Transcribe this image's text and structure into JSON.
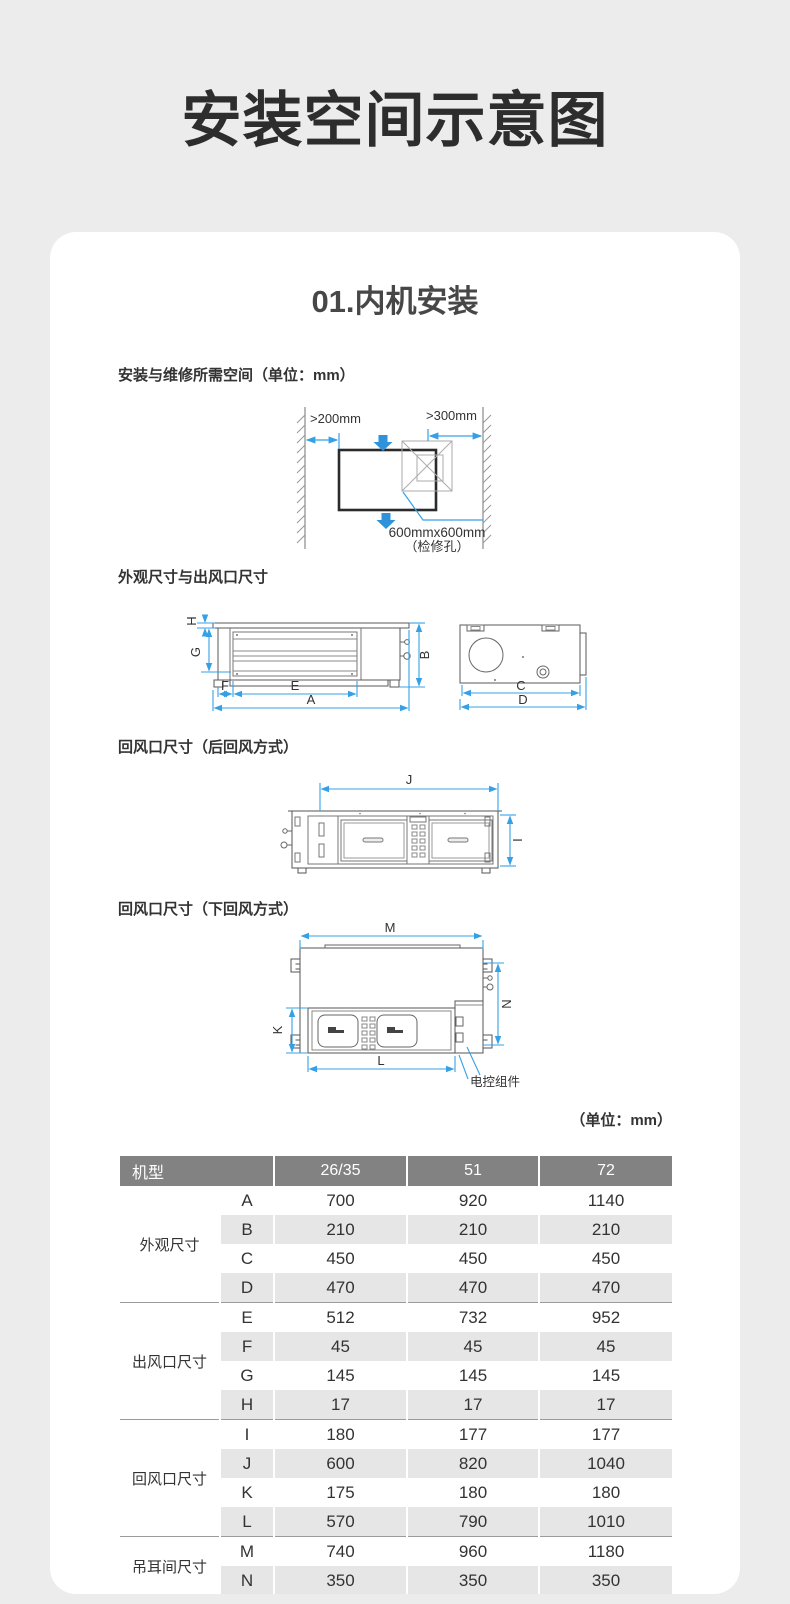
{
  "page": {
    "title": "安装空间示意图",
    "card_title": "01.内机安装",
    "unit_note": "（单位：mm）"
  },
  "colors": {
    "accent_blue": "#35A0E5",
    "arrow_blue": "#2E93DB",
    "table_header_bg": "#828282",
    "table_stripe": "#E6E6E6",
    "page_bg": "#ECECEC"
  },
  "sections": {
    "service_space": {
      "title": "安装与维修所需空间（单位：mm）",
      "left_clearance": ">200mm",
      "right_clearance": ">300mm",
      "hole_size": "600mmx600mm",
      "hole_name": "（检修孔）"
    },
    "outline": {
      "title": "外观尺寸与出风口尺寸",
      "dims": {
        "a": "A",
        "b": "B",
        "c": "C",
        "d": "D",
        "e": "E",
        "f": "F",
        "g": "G",
        "h": "H"
      }
    },
    "rear_return": {
      "title": "回风口尺寸（后回风方式）",
      "dims": {
        "i": "I",
        "j": "J"
      }
    },
    "bottom_return": {
      "title": "回风口尺寸（下回风方式）",
      "dims": {
        "k": "K",
        "l": "L",
        "m": "M",
        "n": "N"
      },
      "control_label": "电控组件"
    }
  },
  "table": {
    "model_label": "机型",
    "columns": [
      "26/35",
      "51",
      "72"
    ],
    "groups": [
      {
        "label": "外观尺寸",
        "rows": [
          [
            "A",
            "700",
            "920",
            "1140"
          ],
          [
            "B",
            "210",
            "210",
            "210"
          ],
          [
            "C",
            "450",
            "450",
            "450"
          ],
          [
            "D",
            "470",
            "470",
            "470"
          ]
        ]
      },
      {
        "label": "出风口尺寸",
        "rows": [
          [
            "E",
            "512",
            "732",
            "952"
          ],
          [
            "F",
            "45",
            "45",
            "45"
          ],
          [
            "G",
            "145",
            "145",
            "145"
          ],
          [
            "H",
            "17",
            "17",
            "17"
          ]
        ]
      },
      {
        "label": "回风口尺寸",
        "rows": [
          [
            "I",
            "180",
            "177",
            "177"
          ],
          [
            "J",
            "600",
            "820",
            "1040"
          ],
          [
            "K",
            "175",
            "180",
            "180"
          ],
          [
            "L",
            "570",
            "790",
            "1010"
          ]
        ]
      },
      {
        "label": "吊耳间尺寸",
        "rows": [
          [
            "M",
            "740",
            "960",
            "1180"
          ],
          [
            "N",
            "350",
            "350",
            "350"
          ]
        ]
      }
    ]
  }
}
